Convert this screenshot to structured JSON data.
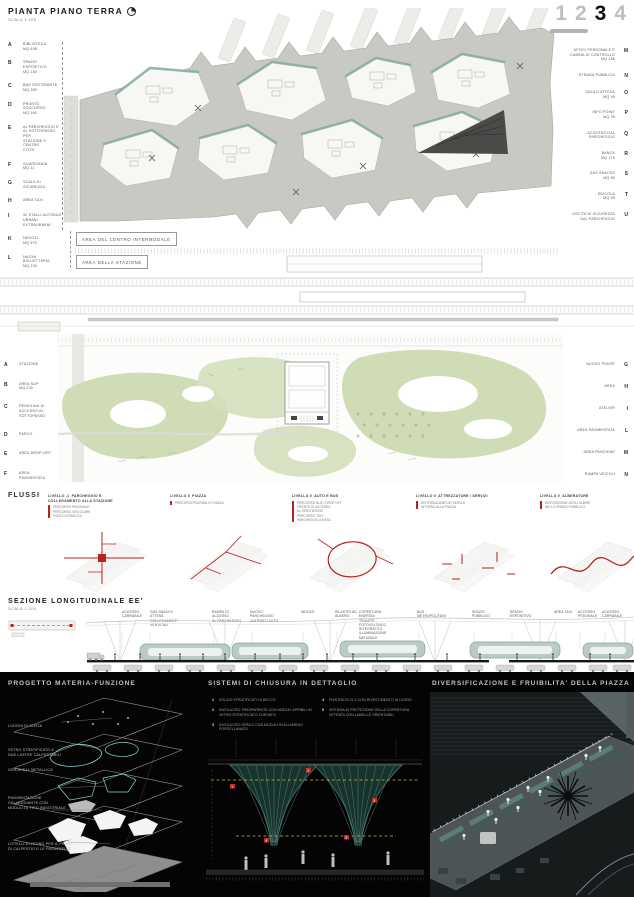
{
  "board": {
    "pagination": {
      "pages": [
        "1",
        "2",
        "3",
        "4"
      ],
      "active": "3"
    }
  },
  "plan_terra": {
    "title": "PIANTA PIANO TERRA",
    "scale": "SCALA 1:200",
    "legend_left": [
      {
        "k": "A",
        "t": "BIBLIOTECA\nMQ 638"
      },
      {
        "k": "B",
        "t": "SPAZIO ESPOSITIVO\nMQ 180"
      },
      {
        "k": "C",
        "t": "BAR RISTORANTE\nMQ 280"
      },
      {
        "k": "D",
        "t": "PRONTO SOCCORSO\nMQ 180"
      },
      {
        "k": "E",
        "t": "AL PARCHEGGIO E\nAL SOTTOPASSO PER\nSTAZIONE E CENTRO\nCITTA'"
      },
      {
        "k": "F",
        "t": "GUARDIANIA\nMQ 11"
      },
      {
        "k": "G",
        "t": "SCALA DI SICUREZZA"
      },
      {
        "k": "H",
        "t": "AREA TAXI"
      },
      {
        "k": "I",
        "t": "32 STALLI AUTOBUS\nURBANI EXTRAURBANI"
      },
      {
        "k": "K",
        "t": "NEGOZI\nMQ 970"
      },
      {
        "k": "L",
        "t": "NUOVA BIGLIETTERIA\nMQ 230"
      }
    ],
    "legend_right": [
      {
        "k": "M",
        "t": "UFFICI PERSONALE E\nCABINA DI CONTROLLO\nMQ 186"
      },
      {
        "k": "N",
        "t": "STRADA PUBBLICA"
      },
      {
        "k": "O",
        "t": "SALA D'ATTESA\nMQ 95"
      },
      {
        "k": "P",
        "t": "INFO POINT\nMQ 95"
      },
      {
        "k": "Q",
        "t": "ACCESSO DAL\nPARCHEGGIO"
      },
      {
        "k": "R",
        "t": "BANCA\nMQ 170"
      },
      {
        "k": "S",
        "t": "GAS SNACKS\nMQ 95"
      },
      {
        "k": "T",
        "t": "EDICOLA\nMQ 95"
      },
      {
        "k": "U",
        "t": "USCITA DI SICUREZZA\nDAL PARCHEGGIO"
      }
    ],
    "area_center": "AREA DEL CENTRO INTERMODALE",
    "area_station": "AREA DELLA STAZIONE"
  },
  "plan_parco": {
    "legend_left": [
      {
        "k": "A",
        "t": "STAZIONE"
      },
      {
        "k": "B",
        "t": "AREA SUP\nMQ 235"
      },
      {
        "k": "C",
        "t": "PENSILINA DI\nACCESSO AL\nSOTTOPASSO"
      },
      {
        "k": "D",
        "t": "PARCO"
      },
      {
        "k": "E",
        "t": "AREA DROP-OFF"
      },
      {
        "k": "F",
        "t": "AREA PAVIMENTATA"
      }
    ],
    "legend_right": [
      {
        "k": "G",
        "t": "NUOVO PONTE"
      },
      {
        "k": "H",
        "t": "AREA"
      },
      {
        "k": "I",
        "t": "ATELIER"
      },
      {
        "k": "L",
        "t": "AREA PAVIMENTATA"
      },
      {
        "k": "M",
        "t": "AREA PANCHINE"
      },
      {
        "k": "N",
        "t": "RAMPA VEICOLI"
      }
    ]
  },
  "flussi": {
    "title": "FLUSSI",
    "diagrams": [
      {
        "label": "LIVELLO -1_PARCHEGGIO E\nCOLLEGAMENTO ALLA STAZIONE",
        "legend": "PERCORSO PEDONALE\nPERCORSO VEICOLARE\nPUNTI DI RISALITA"
      },
      {
        "label": "LIVELLO 0_PIAZZA",
        "legend": "PERCORSI PEDONALI E PIAZZA"
      },
      {
        "label": "LIVELLO 0_AUTO E BUS",
        "legend": "PERCORSO BUS / DROP OFF\nFRONTE DI ACCESSO\nAL PARCHEGGIO\nPERCORSO TAXI /\nPARCHEGGIO A RASO"
      },
      {
        "label": "LIVELLO 0_ATTREZZATURE / SERVIZI",
        "legend": "DISTRIBUZIONE DEI SERVIZI\nINTORNO ALLA PIAZZA"
      },
      {
        "label": "LIVELLO 0_ALBERATURE",
        "legend": "DISPOSIZIONE DEGLI ALBERI\nNELLO SPAZIO PUBBLICO"
      }
    ]
  },
  "sezione": {
    "title": "SEZIONE LONGITUDINALE EE'",
    "scale": "SCALA 1:200",
    "labels": [
      "ACCESSO\nCARRABILE",
      "GAS SNACKS\nATTESA\nCOLLEGAMENTI\nVERTICALI",
      "RAMPA DI ACCESSO\nAL PARCHEGGIO",
      "NUOVO PARCHEGGIO\n215 POSTI AUTO",
      "NEGOZI",
      "PILASTRI AD\nALBERO",
      "COPERTURA: ENERGIA\nTRAMITE FOTOVOLTAICO\nINTEGRATO E\nILLUMINAZIONE\nNATURALE",
      "BUS\nMETROPOLITANI",
      "SPAZIO PUBBLICO",
      "SPAZIO ESPOSITIVO",
      "AREA TAXI",
      "ACCESSO\nPEDONALE",
      "ACCESSO\nCARRABILE"
    ]
  },
  "panel_materia": {
    "title": "PROGETTO MATERIA-FUNZIONE",
    "labels": [
      "LUOGHI DI SOSTA",
      "VETRO STRATIFICATO A\nDUE LASTRE CALPESTABILI",
      "GRIDSHELL METALLICO",
      "PAVIMENTAZIONE\nGALLEGGIANTE CON\nMODULI DI TIPO INDUSTRIALE",
      "LISTELLI DI LEGNO PER IL PIANO\nDI CALPESTIO E LE PASSERELLE"
    ]
  },
  "panel_chiusura": {
    "title": "SISTEMI DI CHIUSURA IN DETTAGLIO",
    "items_left": [
      {
        "n": "1",
        "t": "SOLAIO STRATIFICATO A SECCO"
      },
      {
        "n": "2",
        "t": "INVOLUCRO TRASPARENTE CON MODULI APRIBILI IN VETRO STRATIFICATO CURVATO"
      },
      {
        "n": "3",
        "t": "INVOLUCRO OPACO CON MODULI IN ALLUMINIO PORCELLANATO"
      }
    ],
    "items_right": [
      {
        "n": "4",
        "t": "PIASTRA IN CLS CON RIVESTIMENTO IN LEGNO"
      },
      {
        "n": "5",
        "t": "SISTEMA DI PROTEZIONE DELLA COPERTURA VETRATA CON LAMELLE ORIENTABILI"
      }
    ]
  },
  "panel_piazza": {
    "title": "DIVERSIFICAZIONE E FRUIBILITA' DELLA PIAZZA"
  },
  "colors": {
    "accent_red": "#b5241e",
    "glass_teal": "#7fa69e",
    "park_green": "#cfdcb6",
    "slab_gray": "#c9c9c3",
    "panel_bg": "#040404"
  }
}
